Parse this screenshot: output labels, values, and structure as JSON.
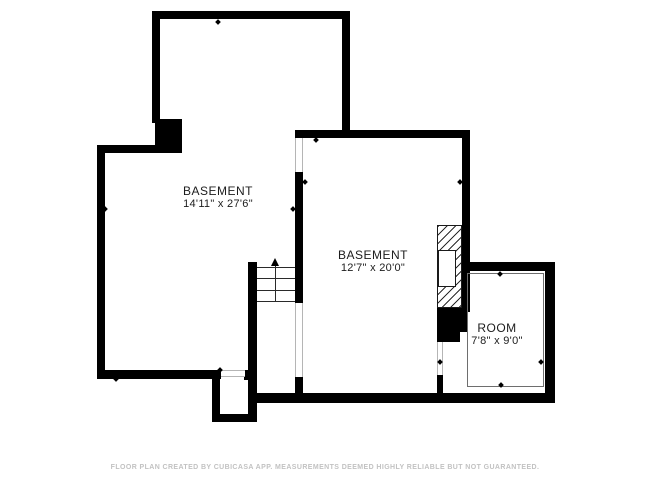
{
  "floor_plan": {
    "rooms": [
      {
        "id": "basement-left",
        "name": "BASEMENT",
        "dimensions": "14'11\" x 27'6\""
      },
      {
        "id": "basement-right",
        "name": "BASEMENT",
        "dimensions": "12'7\" x 20'0\""
      },
      {
        "id": "room-bottom-right",
        "name": "ROOM",
        "dimensions": "7'8\" x 9'0\""
      }
    ],
    "stairs": {
      "direction": "up",
      "treads": 4
    },
    "footer": "FLOOR PLAN CREATED BY CUBICASA APP. MEASUREMENTS DEEMED HIGHLY RELIABLE BUT NOT GUARANTEED.",
    "colors": {
      "wall": "#000000",
      "label_text": "#1c1c1c",
      "footer_text": "#c2c2c2",
      "opening_line": "#b5b5b5",
      "background": "#ffffff"
    }
  }
}
